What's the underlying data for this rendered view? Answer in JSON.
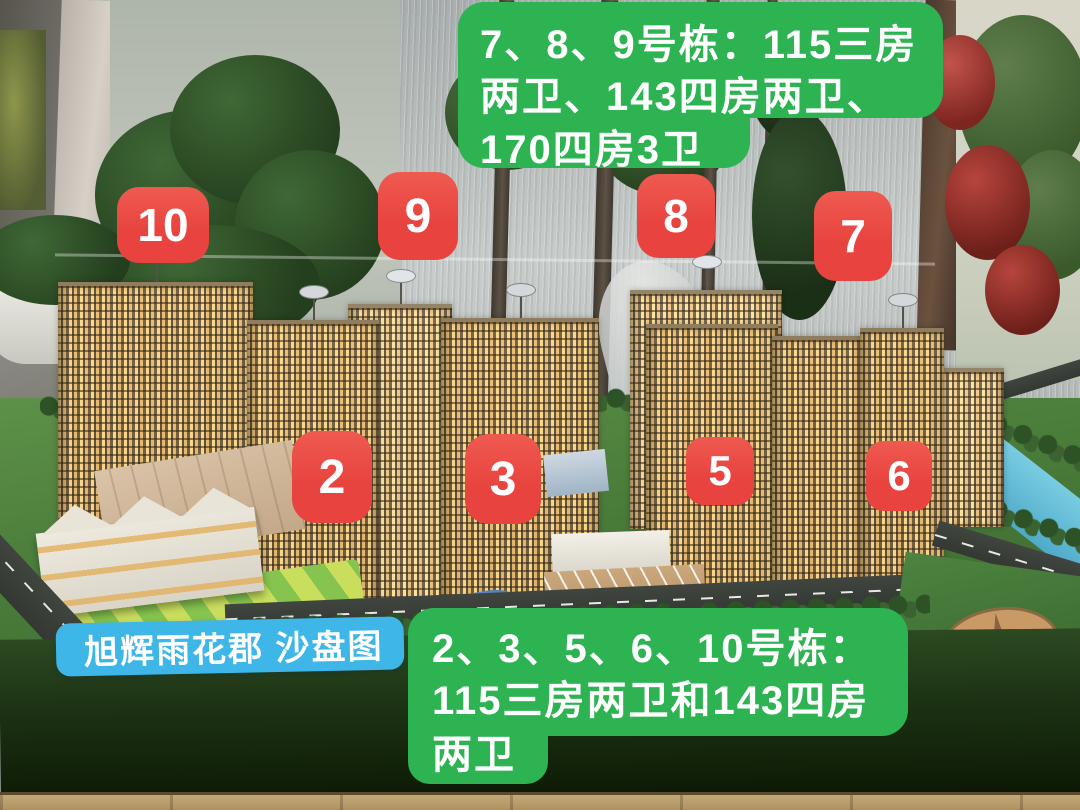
{
  "overlay": {
    "top_note": {
      "line1": "7、8、9号栋：115三房",
      "line2": "两卫、143四房两卫、",
      "line3": "170四房3卫"
    },
    "bottom_note": {
      "line1": "2、3、5、6、10号栋：",
      "line2": "115三房两卫和143四房",
      "line3": "两卫"
    },
    "title_label": "旭辉雨花郡 沙盘图",
    "building_badges": [
      {
        "label": "10"
      },
      {
        "label": "9"
      },
      {
        "label": "8"
      },
      {
        "label": "7"
      },
      {
        "label": "2"
      },
      {
        "label": "3"
      },
      {
        "label": "5"
      },
      {
        "label": "6"
      }
    ],
    "colors": {
      "note_green": "#2db351",
      "badge_red": "#e8433e",
      "label_blue": "#3fb6e8",
      "text_white": "#ffffff"
    }
  }
}
